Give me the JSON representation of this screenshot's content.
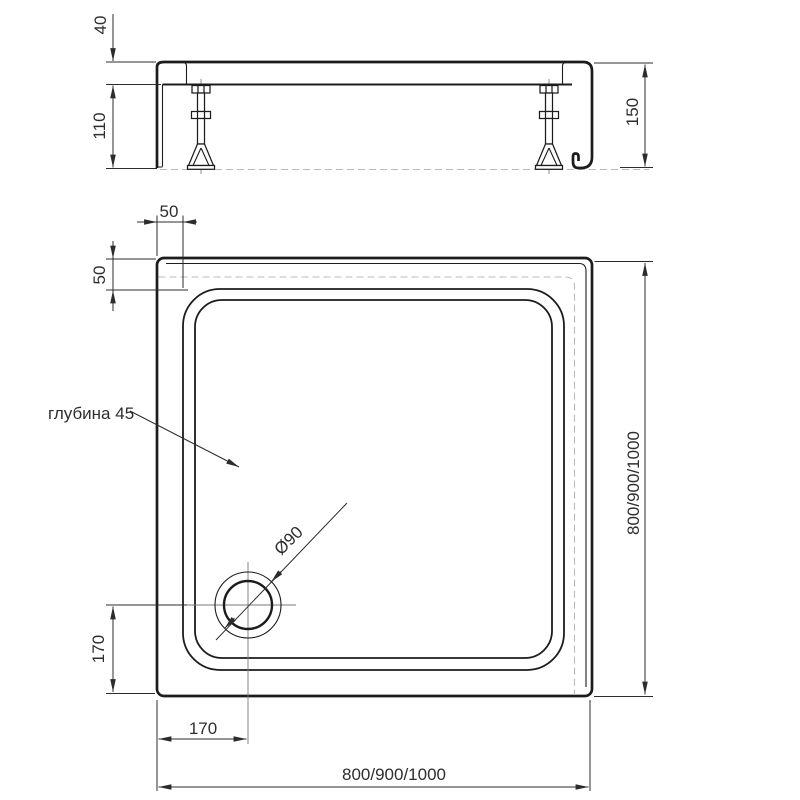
{
  "drawing": {
    "title": "shower-tray-technical-drawing",
    "side_view": {
      "rim_thickness": "40",
      "skirt_height": "110",
      "total_height": "150"
    },
    "plan_view": {
      "rim_width_top": "50",
      "rim_width_side": "50",
      "depth_note": "глубина 45",
      "drain_diameter": "Ø90",
      "drain_offset_left": "170",
      "drain_offset_bottom": "170",
      "overall_width": "800/900/1000",
      "overall_depth": "800/900/1000"
    }
  }
}
